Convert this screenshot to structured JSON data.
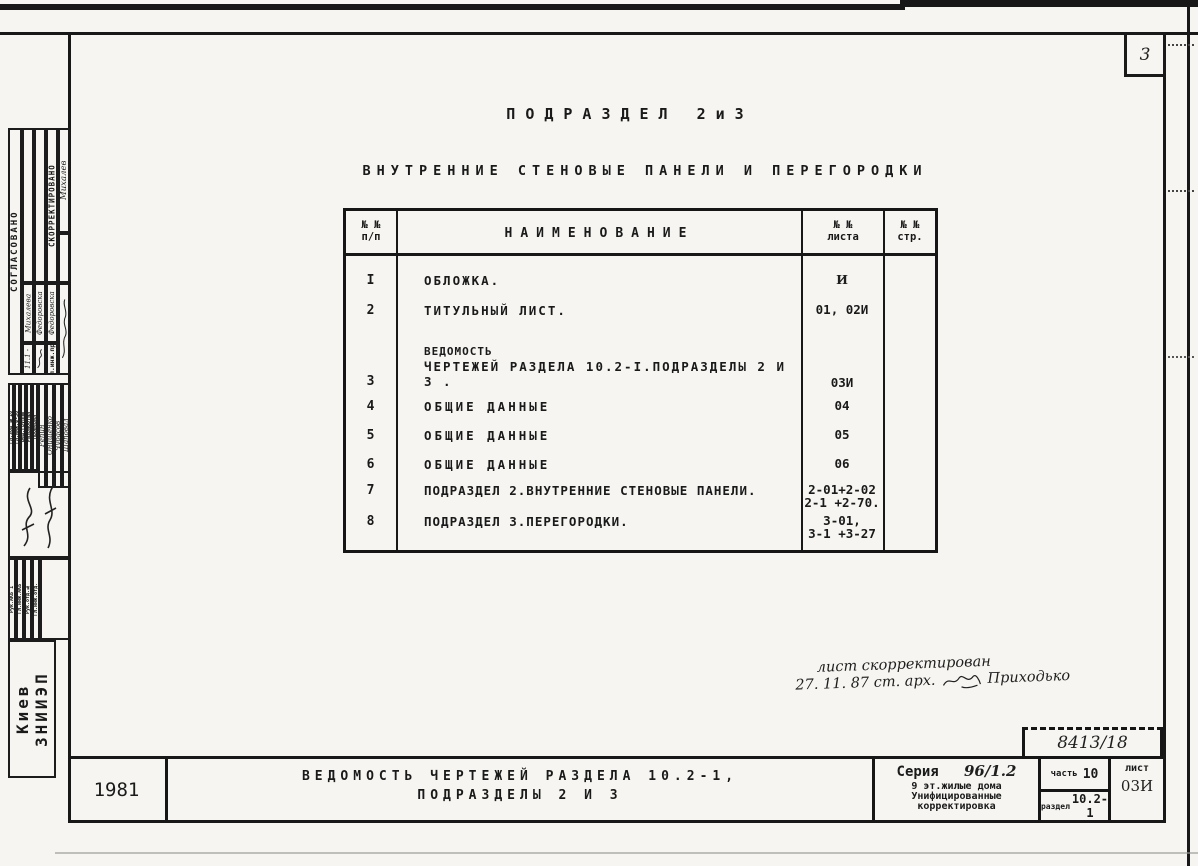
{
  "page": {
    "number": "3"
  },
  "header": {
    "title": "ПОДРАЗДЕЛ  2и3",
    "subtitle": "ВНУТРЕННИЕ  СТЕНОВЫЕ  ПАНЕЛИ  И  ПЕРЕГОРОДКИ"
  },
  "table": {
    "col_num_line1": "№ №",
    "col_num_line2": "п/п",
    "col_name": "НАИМЕНОВАНИЕ",
    "col_sheet_line1": "№ №",
    "col_sheet_line2": "листа",
    "col_page_line1": "№ №",
    "col_page_line2": "стр.",
    "rows": [
      {
        "num": "I",
        "name": "ОБЛОЖКА.",
        "sheet": "И"
      },
      {
        "num": "2",
        "name": "ТИТУЛЬНЫЙ ЛИСТ.",
        "sheet": "01, 02И"
      },
      {
        "num": "3",
        "name_pre": "ВЕДОМОСТЬ",
        "name": "ЧЕРТЕЖЕЙ  РАЗДЕЛА 10.2-I.ПОДРАЗДЕЛЫ  2 И 3 .",
        "sheet": "03И"
      },
      {
        "num": "4",
        "name": "ОБЩИЕ ДАННЫЕ",
        "sheet": "04"
      },
      {
        "num": "5",
        "name": "ОБЩИЕ ДАННЫЕ",
        "sheet": "05"
      },
      {
        "num": "6",
        "name": "ОБЩИЕ ДАННЫЕ",
        "sheet": "06"
      },
      {
        "num": "7",
        "name": "ПОДРАЗДЕЛ 2.ВНУТРЕННИЕ СТЕНОВЫЕ ПАНЕЛИ.",
        "sheet": "2-01+2-02",
        "sheet2": "2-1 +2-70."
      },
      {
        "num": "8",
        "name": "ПОДРАЗДЕЛ 3.ПЕРЕГОРОДКИ.",
        "sheet": "3-01,",
        "sheet2": "3-1 +3-27"
      }
    ]
  },
  "note": {
    "line1": "лист скорректирован",
    "line2": "27. 11. 87    ст. арх.",
    "signature_name": "Приходько"
  },
  "titleblock": {
    "year": "1981",
    "doc_title_line1": "ВЕДОМОСТЬ  ЧЕРТЕЖЕЙ  РАЗДЕЛА  10.2-1,",
    "doc_title_line2": "ПОДРАЗДЕЛЫ  2  И  3",
    "series_label": "Серия",
    "series_value": "96/1.2",
    "series_line1": "9 эт.жилые дома",
    "series_line2": "Унифицированные",
    "series_line3": "корректировка",
    "part_label": "часть",
    "part_value": "10",
    "section_label": "раздел",
    "section_value": "10.2-1",
    "sheet_label": "лист",
    "sheet_value": "03И",
    "doc_number": "8413/18"
  },
  "sidebar": {
    "approved": "СОГЛАСОВАНО",
    "corrected": "СКОРРЕКТИРОВАНО",
    "chief_engineer_label": "Гл.инж.пр.",
    "chief_engineer_name": "Михалев",
    "name1": "Михалева",
    "name1_note": "11.1 -",
    "name2": "Федоровска",
    "name3": "Федоровска",
    "roles": [
      "Гл.зод №10",
      "Гл.инж.ф-30",
      "Вед.группы",
      "Разработал",
      "Проверил"
    ],
    "signers": [
      "Репин",
      "Онищенко",
      "Чубасов",
      "Шаповал"
    ],
    "dept_cells": [
      "Рук.АКБ 1",
      "Гл.инж.АКБ",
      "Рук.отд.№",
      "Гл.инж.отд."
    ],
    "org": "Киев ЗНИИЭП"
  }
}
